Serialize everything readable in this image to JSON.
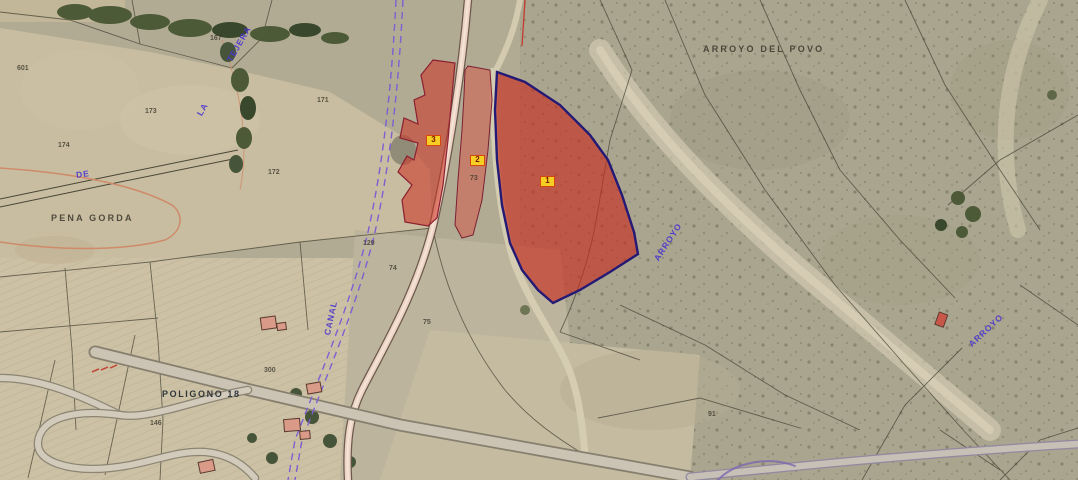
{
  "map": {
    "region_labels": [
      {
        "name": "arroyo-del-povo",
        "text": "ARROYO DEL POVO"
      },
      {
        "name": "pena-gorda",
        "text": "PENA GORDA"
      },
      {
        "name": "poligono-18",
        "text": "POLIGONO 18"
      },
      {
        "name": "la",
        "text": "LA"
      },
      {
        "name": "tejera",
        "text": "TEJERA"
      },
      {
        "name": "de",
        "text": "DE"
      },
      {
        "name": "canal",
        "text": "CANAL"
      },
      {
        "name": "arroyo-center",
        "text": "ARROYO"
      },
      {
        "name": "arroyo-east",
        "text": "ARROYO"
      }
    ],
    "highlighted_parcels": [
      {
        "label": "1"
      },
      {
        "label": "2"
      },
      {
        "label": "3"
      }
    ],
    "parcel_numbers": [
      "601",
      "167",
      "173",
      "174",
      "171",
      "172",
      "129",
      "74",
      "75",
      "73",
      "300",
      "146",
      "91"
    ],
    "colors": {
      "highlight_parcel_fill": "#cc3527",
      "parcel_1_border": "#241a75",
      "badge_background": "#f6cf25",
      "badge_border": "#d4470e",
      "canal_line": "#7e5fd2",
      "toponym_blue": "#4b36cf",
      "toponym_black": "#3a362c",
      "road_fill": "#ecd3c4"
    }
  }
}
